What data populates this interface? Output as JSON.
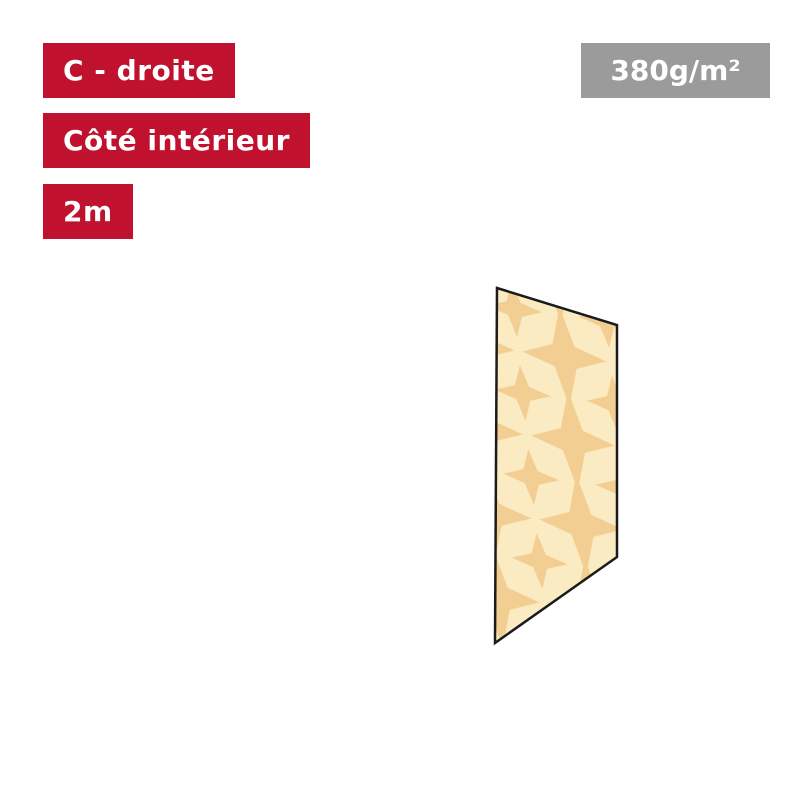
{
  "annotations": {
    "panel_variant": "C - droite",
    "side": "Côté intérieur",
    "width": "2m",
    "fabric_weight": "380g/m²"
  },
  "colors": {
    "page_background": "#ffffff",
    "label_bg": "#c0122e",
    "label_text": "#ffffff",
    "badge_bg": "#9b9b9b",
    "badge_text": "#ffffff",
    "fabric_base": "#fbebc2",
    "fabric_star": "#f2ce92",
    "panel_outline": "#1b1b1b"
  },
  "panel": {
    "description": "right-side panel preview, interior face, star-print fabric"
  }
}
